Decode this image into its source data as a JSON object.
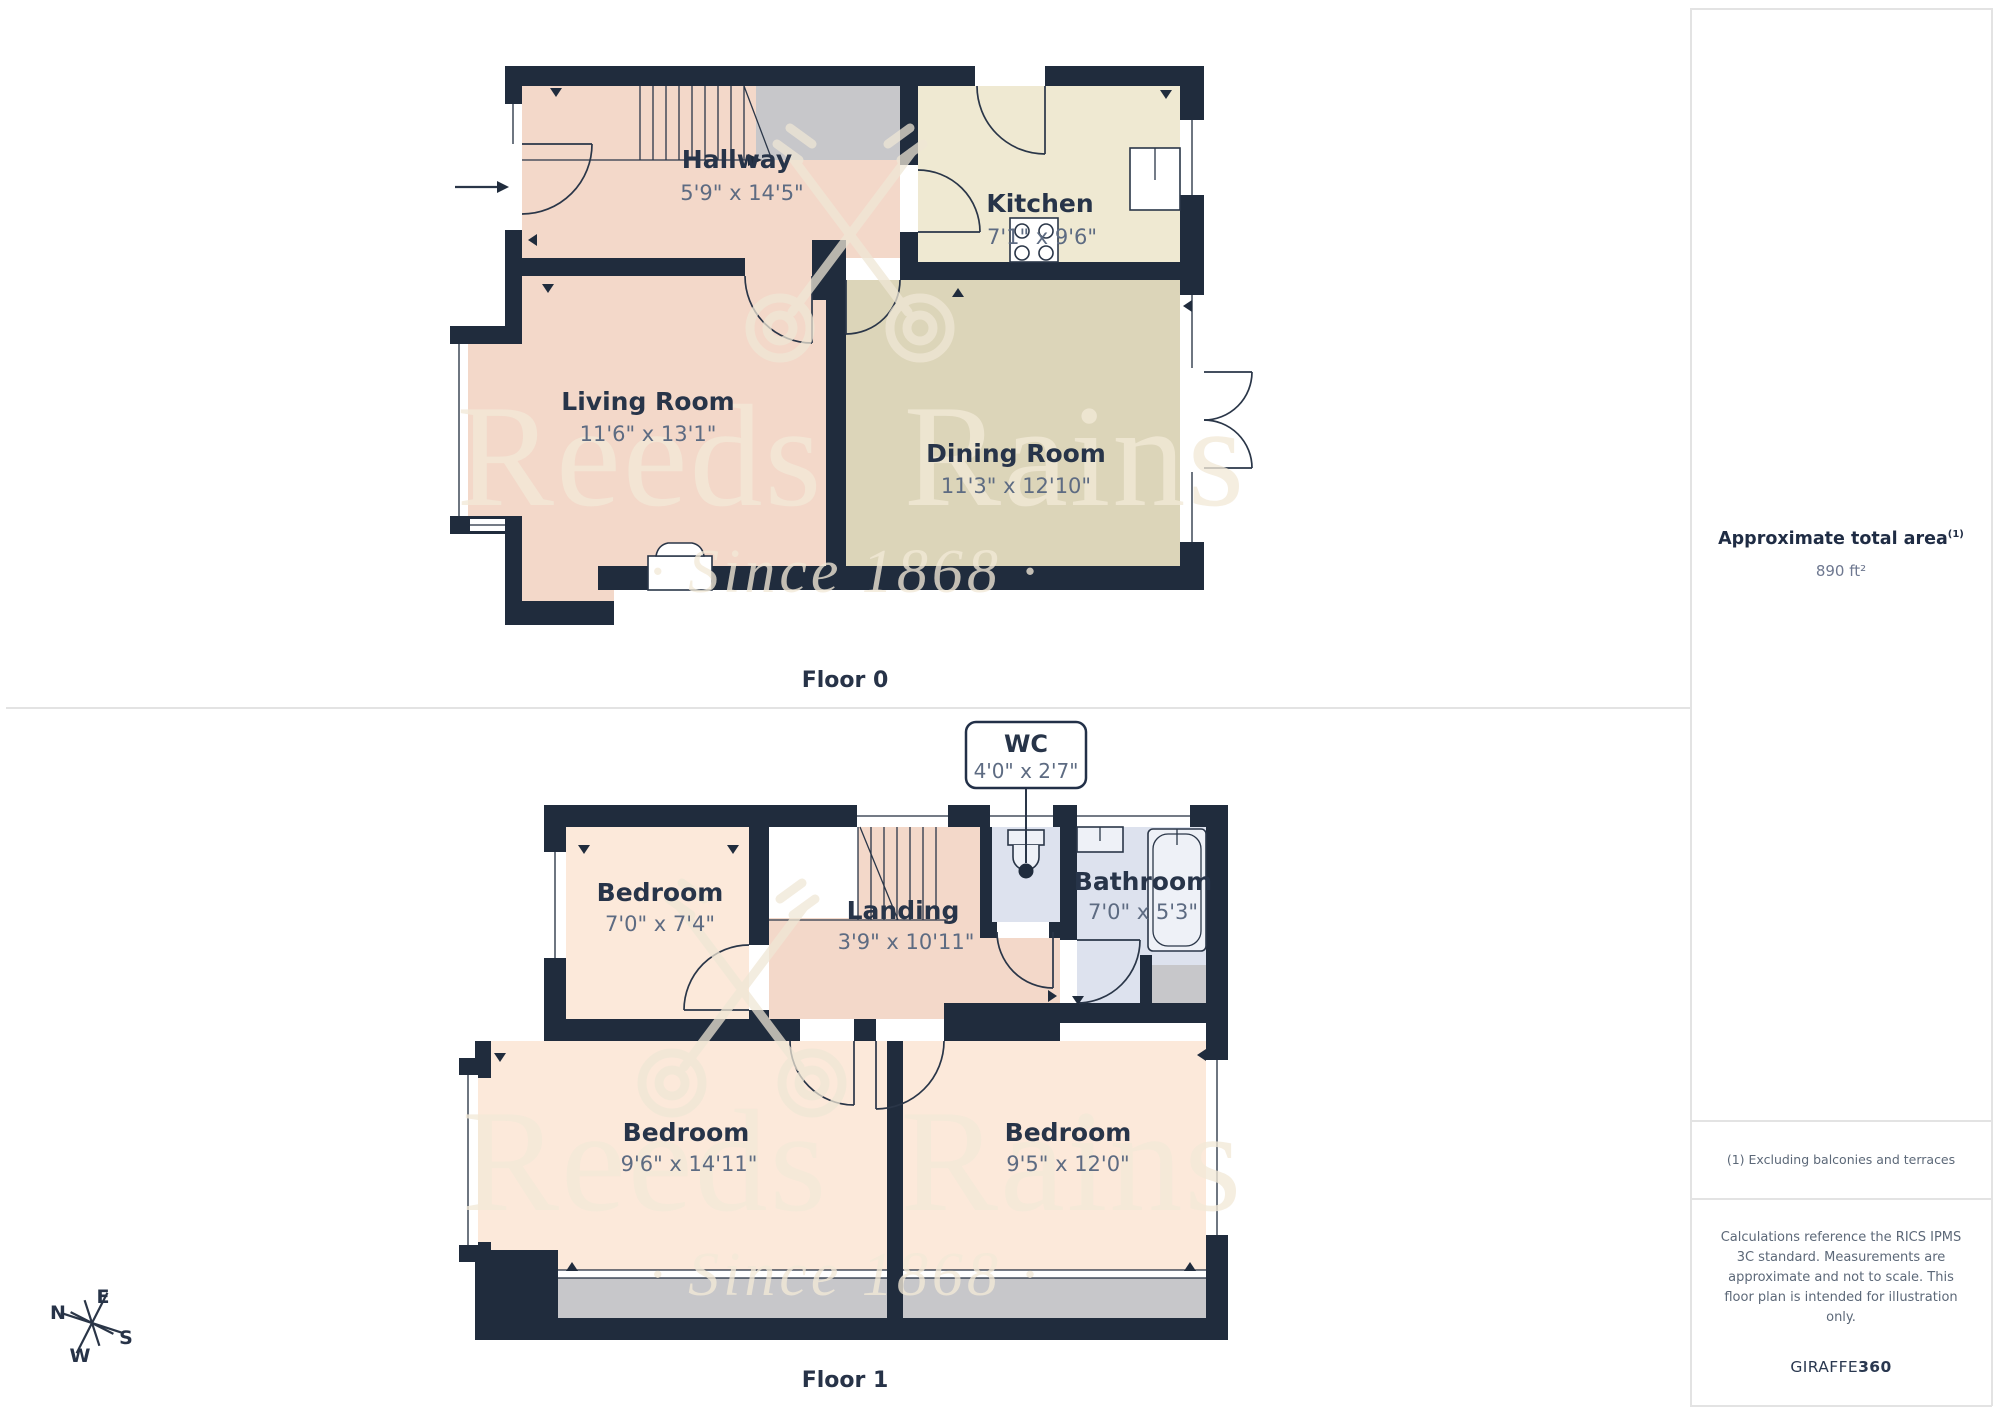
{
  "floor0": {
    "caption": "Floor 0",
    "rooms": {
      "hallway": {
        "name": "Hallway",
        "dims": "5'9\" x 14'5\""
      },
      "kitchen": {
        "name": "Kitchen",
        "dims": "7'1\" x 9'6\""
      },
      "living": {
        "name": "Living Room",
        "dims": "11'6\" x 13'1\""
      },
      "dining": {
        "name": "Dining Room",
        "dims": "11'3\" x 12'10\""
      }
    }
  },
  "floor1": {
    "caption": "Floor 1",
    "rooms": {
      "wc": {
        "name": "WC",
        "dims": "4'0\" x 2'7\""
      },
      "bedroom_small": {
        "name": "Bedroom",
        "dims": "7'0\" x 7'4\""
      },
      "landing": {
        "name": "Landing",
        "dims": "3'9\" x 10'11\""
      },
      "bathroom": {
        "name": "Bathroom",
        "dims": "7'0\" x 5'3\""
      },
      "bedroom_left": {
        "name": "Bedroom",
        "dims": "9'6\" x 14'11\""
      },
      "bedroom_right": {
        "name": "Bedroom",
        "dims": "9'5\" x 12'0\""
      }
    }
  },
  "sidebar": {
    "area_title": "Approximate total area",
    "area_footnote_marker": "(1)",
    "area_value": "890 ft²",
    "footnote": "(1) Excluding balconies and terraces",
    "disclaimer": "Calculations reference the RICS IPMS 3C standard. Measurements are approximate and not to scale. This floor plan is intended for illustration only.",
    "brand_name": "GIRAFFE",
    "brand_number": "360"
  },
  "watermark": {
    "word1": "Reeds",
    "word2": "Rains",
    "tagline": "· Since 1868 ·"
  },
  "compass": {
    "n": "N",
    "e": "E",
    "s": "S",
    "w": "W"
  },
  "colors": {
    "wall": "#202c3d",
    "hall_living": "#f3d8c9",
    "bedroom": "#fce9da",
    "kitchen": "#efe9d2",
    "dining": "#dcd5b9",
    "bathroom": "#dde2ee",
    "gray": "#c7c7ca",
    "watermark": "#f2e9d8"
  }
}
